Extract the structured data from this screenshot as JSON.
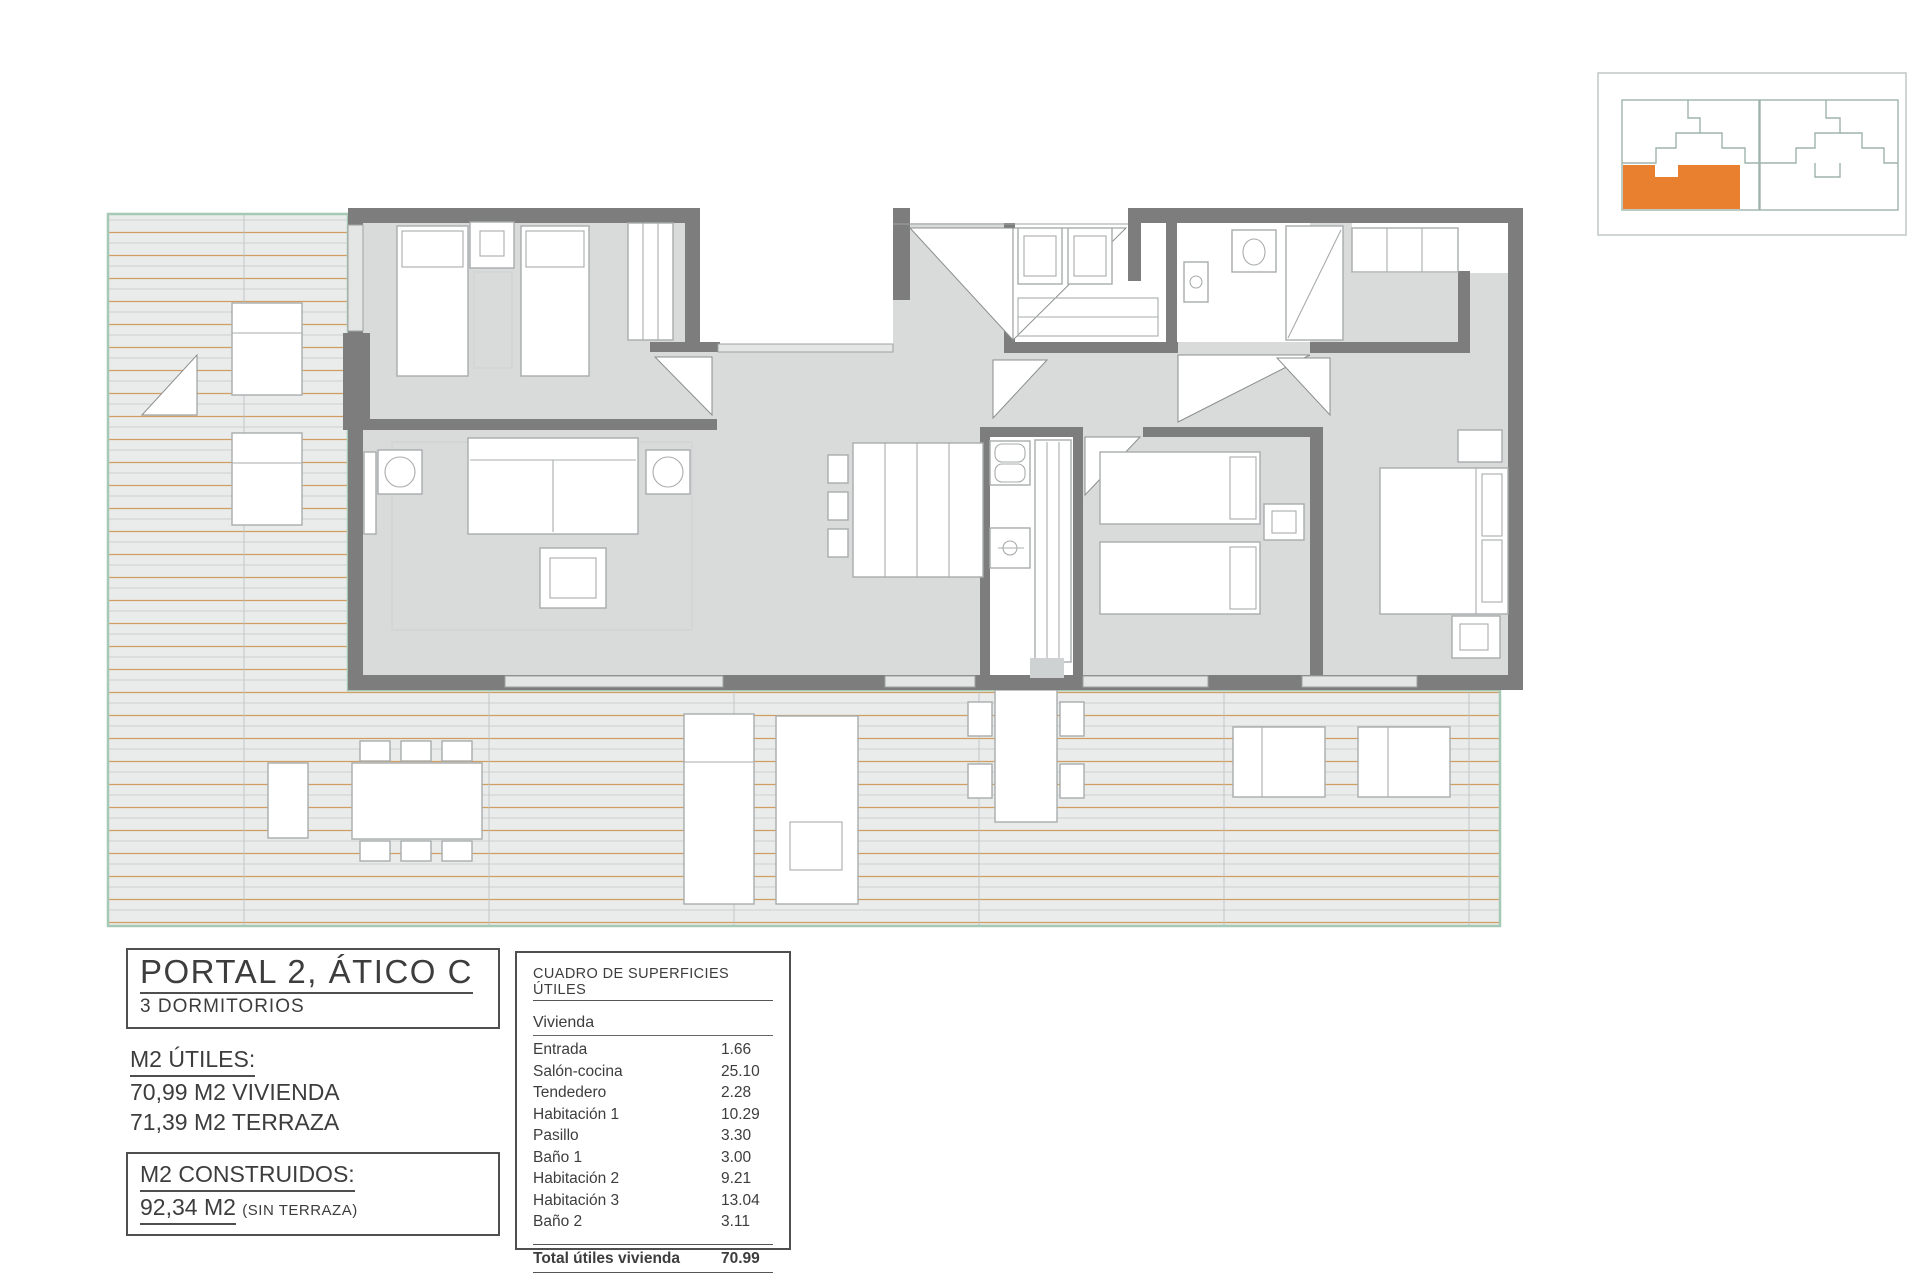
{
  "title_block": {
    "title": "PORTAL 2, ÁTICO C",
    "subtitle": "3 DORMITORIOS"
  },
  "areas_utiles": {
    "heading": "M2 ÚTILES:",
    "line1": "70,99 M2 VIVIENDA",
    "line2": "71,39 M2 TERRAZA"
  },
  "areas_construidos": {
    "heading": "M2 CONSTRUIDOS:",
    "value": "92,34 M2",
    "note": "(SIN TERRAZA)"
  },
  "surface_table": {
    "title": "CUADRO DE SUPERFICIES ÚTILES",
    "group_label": "Vivienda",
    "rows": [
      {
        "label": "Entrada",
        "value": "1.66"
      },
      {
        "label": "Salón-cocina",
        "value": "25.10"
      },
      {
        "label": "Tendedero",
        "value": "2.28"
      },
      {
        "label": "Habitación 1",
        "value": "10.29"
      },
      {
        "label": "Pasillo",
        "value": "3.30"
      },
      {
        "label": "Baño 1",
        "value": "3.00"
      },
      {
        "label": "Habitación 2",
        "value": "9.21"
      },
      {
        "label": "Habitación 3",
        "value": "13.04"
      },
      {
        "label": "Baño 2",
        "value": "3.11"
      }
    ],
    "total": {
      "label": "Total útiles vivienda",
      "value": "70.99"
    }
  },
  "minimap": {
    "highlight_color": "#e8802f",
    "border_color": "#c4cbc8",
    "outline_color": "#9fb3ab"
  },
  "floorplan": {
    "colors": {
      "wall": "#7d7d7d",
      "floor": "#d9dbdb",
      "terrace_fill": "#eaecec",
      "terrace_border": "#a5c9b5",
      "deck_line_orange": "#cf9e63",
      "deck_line_gray": "#c6c9c9",
      "furniture_stroke": "#a9acac"
    }
  }
}
